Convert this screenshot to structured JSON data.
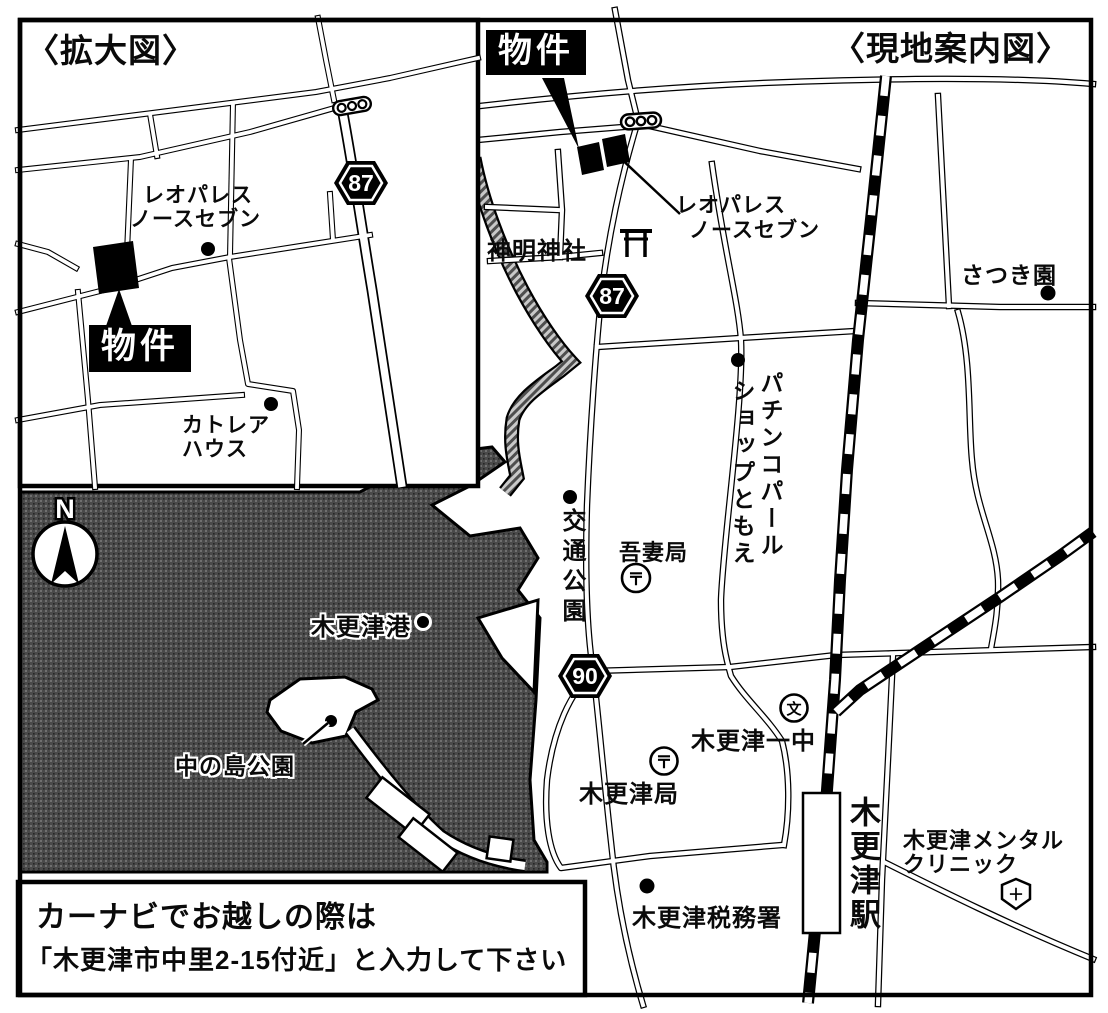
{
  "inset_map": {
    "title": "〈拡大図〉",
    "property_label": "物件",
    "route_shield": "87",
    "leopalace_line1": "レオパレス",
    "leopalace_line2": "ノースセブン",
    "cattleya_line1": "カトレア",
    "cattleya_line2": "ハウス"
  },
  "main_map": {
    "title": "〈現地案内図〉",
    "property_label": "物件",
    "route_shield_87": "87",
    "route_shield_90": "90",
    "shinmei_shrine": "神明神社",
    "leopalace_line1": "レオパレス",
    "leopalace_line2": "ノースセブン",
    "satsuki_en": "さつき園",
    "pachinko_line1": "パチンコパール",
    "pachinko_line2": "ショップともえ",
    "kotsu_koen": "交通公園",
    "azuma_post_office": "吾妻局",
    "kisarazu_port": "木更津港",
    "nakanoshima_park": "中の島公園",
    "kisarazu_ichichu": "木更津一中",
    "kisarazu_post_office": "木更津局",
    "kisarazu_tax_office": "木更津税務署",
    "kisarazu_station": "木更津駅",
    "mental_clinic_line1": "木更津メンタル",
    "mental_clinic_line2": "クリニック",
    "compass_north": "N",
    "post_office_mark": "〒",
    "school_mark": "文",
    "hospital_mark": "＋"
  },
  "caption_box": {
    "line1": "カーナビでお越しの際は",
    "line2": "「木更津市中里2-15付近」と入力して下さい"
  }
}
